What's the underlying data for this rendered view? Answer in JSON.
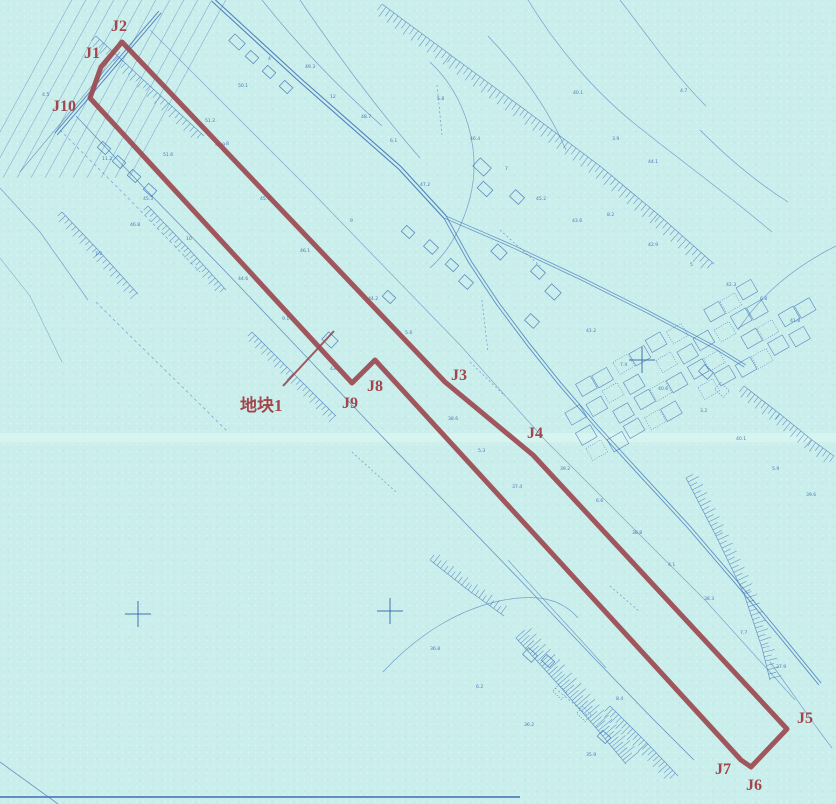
{
  "canvas": {
    "w": 836,
    "h": 804,
    "bg": "#c9eeec"
  },
  "colors": {
    "blue": "#3e6db4",
    "blue_dark": "#2c5ca4",
    "red": "#9b4950",
    "red_text": "#a2464c",
    "crease": "#daf5f1",
    "crease_edge": "#bfe2dc"
  },
  "boundary": {
    "stroke_width": 5,
    "vertices": [
      {
        "name": "J2",
        "x": 122,
        "y": 42,
        "label_x": 111,
        "label_y": 31
      },
      {
        "name": "J3",
        "x": 445,
        "y": 382,
        "label_x": 451,
        "label_y": 380
      },
      {
        "name": "J4",
        "x": 533,
        "y": 455,
        "label_x": 527,
        "label_y": 438
      },
      {
        "name": "J5",
        "x": 787,
        "y": 729,
        "label_x": 797,
        "label_y": 723
      },
      {
        "name": "J6",
        "x": 751,
        "y": 767,
        "label_x": 746,
        "label_y": 790
      },
      {
        "name": "J7",
        "x": 741,
        "y": 760,
        "label_x": 715,
        "label_y": 774
      },
      {
        "name": "J8",
        "x": 375,
        "y": 360,
        "label_x": 367,
        "label_y": 391
      },
      {
        "name": "J9",
        "x": 352,
        "y": 383,
        "label_x": 342,
        "label_y": 408
      },
      {
        "name": "J10",
        "x": 90,
        "y": 98,
        "label_x": 52,
        "label_y": 111
      },
      {
        "name": "J1",
        "x": 101,
        "y": 67,
        "label_x": 84,
        "label_y": 58
      }
    ],
    "plot_label": {
      "text": "地块1",
      "x": 240,
      "y": 411,
      "size": 17
    },
    "leader": [
      283,
      386,
      334,
      331
    ]
  },
  "map_features": {
    "crease": {
      "y": 433,
      "h": 11,
      "line_y": 443
    },
    "fan_lines": [
      [
        -25,
        178,
        75,
        -6
      ],
      [
        -11,
        178,
        89,
        -6
      ],
      [
        3,
        178,
        103,
        -6
      ],
      [
        17,
        178,
        117,
        -6
      ],
      [
        31,
        178,
        131,
        -6
      ],
      [
        45,
        178,
        145,
        -6
      ],
      [
        59,
        178,
        159,
        -6
      ],
      [
        73,
        178,
        173,
        -6
      ],
      [
        87,
        178,
        187,
        -6
      ],
      [
        101,
        178,
        201,
        -6
      ],
      [
        115,
        178,
        215,
        -6
      ],
      [
        129,
        178,
        229,
        -6
      ]
    ],
    "roads": [
      {
        "p": [
          [
            213,
            0
          ],
          [
            300,
            80
          ],
          [
            400,
            168
          ],
          [
            445,
            217
          ]
        ],
        "w": 1.1,
        "double": true,
        "gap": 3.4,
        "o": 0.85
      },
      {
        "p": [
          [
            445,
            217
          ],
          [
            512,
            246
          ],
          [
            580,
            278
          ],
          [
            648,
            312
          ],
          [
            716,
            348
          ],
          [
            745,
            366
          ]
        ],
        "w": 0.8,
        "double": true,
        "gap": 2.6,
        "o": 0.7
      },
      {
        "p": [
          [
            445,
            217
          ],
          [
            470,
            262
          ],
          [
            498,
            304
          ],
          [
            528,
            344
          ],
          [
            560,
            384
          ],
          [
            598,
            428
          ],
          [
            640,
            474
          ],
          [
            688,
            526
          ],
          [
            736,
            582
          ],
          [
            784,
            640
          ],
          [
            820,
            684
          ]
        ],
        "w": 0.9,
        "double": true,
        "gap": 3,
        "o": 0.75
      },
      {
        "p": [
          [
            76,
            116
          ],
          [
            150,
            194
          ],
          [
            224,
            270
          ],
          [
            298,
            348
          ],
          [
            372,
            426
          ],
          [
            446,
            503
          ],
          [
            520,
            580
          ],
          [
            594,
            658
          ],
          [
            652,
            718
          ],
          [
            694,
            760
          ]
        ],
        "w": 0.8,
        "o": 0.7
      },
      {
        "p": [
          [
            56,
            134
          ],
          [
            160,
            12
          ]
        ],
        "w": 1.0,
        "double": true,
        "gap": 3,
        "o": 0.8
      },
      {
        "p": [
          [
            20,
            172
          ],
          [
            120,
            52
          ]
        ],
        "w": 0.7,
        "o": 0.6
      },
      {
        "p": [
          [
            150,
            30
          ],
          [
            310,
            190
          ],
          [
            460,
            345
          ],
          [
            545,
            440
          ],
          [
            705,
            600
          ],
          [
            795,
            700
          ]
        ],
        "w": 0.7,
        "o": 0.55
      },
      {
        "p": [
          [
            60,
            130
          ],
          [
            130,
            200
          ],
          [
            200,
            272
          ]
        ],
        "w": 0.7,
        "dash": "3 3",
        "o": 0.6
      },
      {
        "p": [
          [
            0,
            188
          ],
          [
            40,
            232
          ],
          [
            88,
            300
          ]
        ],
        "w": 0.7,
        "o": 0.6
      },
      {
        "p": [
          [
            0,
            258
          ],
          [
            30,
            296
          ],
          [
            62,
            362
          ]
        ],
        "w": 0.6,
        "o": 0.5
      }
    ],
    "contours": [
      {
        "d": "M 262,0 C 300,48 344,92 382,126"
      },
      {
        "d": "M 300,0 C 338,56 380,112 420,158"
      },
      {
        "d": "M 528,0 C 556,46 594,92 640,128 C 688,166 732,198 772,232"
      },
      {
        "d": "M 620,0 C 648,36 672,72 706,106"
      },
      {
        "d": "M 430,62 C 466,96 482,150 470,198 C 462,228 448,252 430,268"
      },
      {
        "d": "M 488,36 C 520,70 548,108 566,150"
      },
      {
        "d": "M 836,246 C 792,268 760,296 738,330"
      },
      {
        "d": "M 383,672 C 420,632 462,608 504,600 C 544,593 564,602 578,618"
      },
      {
        "d": "M 770,662 C 792,692 812,722 832,748"
      },
      {
        "d": "M 700,130 C 728,158 756,182 788,202"
      },
      {
        "d": "M 96,302 C 140,346 186,390 228,432",
        "dash": "3 3"
      },
      {
        "d": "M 508,560 C 540,596 574,632 606,668"
      }
    ],
    "dashed_lines": [
      [
        437,
        85,
        442,
        135
      ],
      [
        482,
        300,
        488,
        352
      ],
      [
        500,
        230,
        540,
        266
      ],
      [
        352,
        452,
        396,
        492
      ],
      [
        555,
        688,
        588,
        716
      ],
      [
        610,
        586,
        640,
        612
      ],
      [
        470,
        362,
        505,
        396
      ]
    ],
    "ladders": [
      {
        "p": [
          [
            382,
            4
          ],
          [
            452,
            56
          ],
          [
            528,
            112
          ],
          [
            600,
            166
          ],
          [
            660,
            216
          ],
          [
            714,
            264
          ]
        ],
        "w": 12,
        "step": 5,
        "side": 1
      },
      {
        "p": [
          [
            96,
            36
          ],
          [
            150,
            86
          ],
          [
            204,
            136
          ]
        ],
        "w": 10,
        "step": 5,
        "side": 1
      },
      {
        "p": [
          [
            148,
            206
          ],
          [
            188,
            248
          ],
          [
            226,
            290
          ]
        ],
        "w": 9,
        "step": 4.5,
        "side": 1
      },
      {
        "p": [
          [
            252,
            332
          ],
          [
            294,
            374
          ],
          [
            336,
            416
          ]
        ],
        "w": 9,
        "step": 4.5,
        "side": 1
      },
      {
        "p": [
          [
            430,
            560
          ],
          [
            468,
            590
          ],
          [
            504,
            616
          ]
        ],
        "w": 10,
        "step": 4.5,
        "side": -1
      },
      {
        "p": [
          [
            516,
            638
          ],
          [
            556,
            682
          ],
          [
            596,
            728
          ],
          [
            626,
            764
          ]
        ],
        "w": 18,
        "step": 3.5,
        "side": -1
      },
      {
        "p": [
          [
            610,
            706
          ],
          [
            648,
            744
          ],
          [
            678,
            776
          ]
        ],
        "w": 12,
        "step": 4,
        "side": 1
      },
      {
        "p": [
          [
            686,
            478
          ],
          [
            716,
            536
          ],
          [
            744,
            594
          ],
          [
            762,
            648
          ],
          [
            770,
            680
          ]
        ],
        "w": 12,
        "step": 4.5,
        "side": -1
      },
      {
        "p": [
          [
            744,
            386
          ],
          [
            780,
            414
          ],
          [
            812,
            440
          ],
          [
            834,
            456
          ]
        ],
        "w": 11,
        "step": 4.5,
        "side": 1
      },
      {
        "p": [
          [
            62,
            212
          ],
          [
            100,
            252
          ],
          [
            138,
            294
          ]
        ],
        "w": 9,
        "step": 5,
        "side": 1
      }
    ],
    "buildings": [
      [
        104,
        148,
        11,
        8,
        43,
        0
      ],
      [
        119,
        162,
        11,
        8,
        43,
        0
      ],
      [
        134,
        176,
        11,
        8,
        43,
        0
      ],
      [
        150,
        190,
        11,
        8,
        43,
        0
      ],
      [
        237,
        42,
        14,
        9,
        43,
        0
      ],
      [
        252,
        57,
        11,
        8,
        43,
        0
      ],
      [
        269,
        72,
        11,
        8,
        43,
        0
      ],
      [
        286,
        87,
        11,
        8,
        43,
        0
      ],
      [
        482,
        167,
        15,
        11,
        43,
        0
      ],
      [
        485,
        189,
        13,
        9,
        43,
        0
      ],
      [
        517,
        197,
        12,
        9,
        43,
        0
      ],
      [
        408,
        232,
        11,
        8,
        43,
        0
      ],
      [
        431,
        247,
        12,
        9,
        43,
        0
      ],
      [
        452,
        265,
        11,
        8,
        43,
        0
      ],
      [
        466,
        282,
        12,
        9,
        43,
        0
      ],
      [
        499,
        252,
        13,
        10,
        43,
        0
      ],
      [
        538,
        272,
        12,
        9,
        43,
        0
      ],
      [
        553,
        292,
        13,
        10,
        43,
        0
      ],
      [
        532,
        321,
        12,
        9,
        43,
        0
      ],
      [
        389,
        297,
        11,
        8,
        43,
        0
      ],
      [
        330,
        340,
        13,
        10,
        43,
        0
      ],
      [
        530,
        655,
        12,
        9,
        43,
        0
      ],
      [
        548,
        661,
        11,
        8,
        43,
        0
      ],
      [
        560,
        692,
        12,
        9,
        43,
        1
      ],
      [
        584,
        714,
        12,
        9,
        43,
        1
      ],
      [
        604,
        737,
        11,
        8,
        43,
        0
      ],
      [
        706,
        372,
        12,
        9,
        43,
        0
      ],
      [
        722,
        390,
        12,
        9,
        43,
        1
      ]
    ],
    "parcel_grid": {
      "origin": [
        568,
        398
      ],
      "row_dir": [
        0.865,
        -0.5
      ],
      "col_dir": [
        0.5,
        0.865
      ],
      "pitch": 21,
      "cell": 17,
      "angle": -30,
      "cols_per_row": [
        11,
        12,
        13,
        13
      ],
      "skip_every": 7
    },
    "crosses": [
      [
        138,
        614
      ],
      [
        390,
        611
      ],
      [
        642,
        360
      ]
    ],
    "cross_arm": 13,
    "tiny_labels": [
      [
        42,
        96,
        "4.5"
      ],
      [
        205,
        122,
        "51.2"
      ],
      [
        226,
        145,
        "8"
      ],
      [
        130,
        226,
        "46.8"
      ],
      [
        95,
        255,
        "7.2"
      ],
      [
        163,
        156,
        "51.6"
      ],
      [
        238,
        87,
        "50.1"
      ],
      [
        268,
        60,
        "4"
      ],
      [
        305,
        68,
        "49.3"
      ],
      [
        330,
        98,
        "12"
      ],
      [
        361,
        118,
        "48.7"
      ],
      [
        390,
        142,
        "6.1"
      ],
      [
        420,
        186,
        "47.2"
      ],
      [
        350,
        222,
        "9"
      ],
      [
        300,
        252,
        "46.1"
      ],
      [
        260,
        200,
        "45.7"
      ],
      [
        215,
        146,
        "44.9"
      ],
      [
        437,
        100,
        "5.8"
      ],
      [
        470,
        140,
        "46.4"
      ],
      [
        505,
        170,
        "7"
      ],
      [
        536,
        200,
        "45.2"
      ],
      [
        573,
        94,
        "40.1"
      ],
      [
        612,
        140,
        "3.9"
      ],
      [
        648,
        163,
        "44.1"
      ],
      [
        680,
        92,
        "4.7"
      ],
      [
        572,
        222,
        "43.6"
      ],
      [
        607,
        216,
        "8.2"
      ],
      [
        648,
        246,
        "42.9"
      ],
      [
        690,
        266,
        "5"
      ],
      [
        726,
        286,
        "42.3"
      ],
      [
        760,
        300,
        "6.8"
      ],
      [
        790,
        322,
        "41.8"
      ],
      [
        586,
        332,
        "41.2"
      ],
      [
        620,
        366,
        "7.4"
      ],
      [
        658,
        390,
        "40.6"
      ],
      [
        700,
        412,
        "3.2"
      ],
      [
        736,
        440,
        "40.1"
      ],
      [
        772,
        470,
        "5.9"
      ],
      [
        806,
        496,
        "39.6"
      ],
      [
        560,
        470,
        "39.2"
      ],
      [
        596,
        502,
        "6.6"
      ],
      [
        632,
        534,
        "38.8"
      ],
      [
        668,
        566,
        "4.1"
      ],
      [
        704,
        600,
        "38.3"
      ],
      [
        740,
        634,
        "7.7"
      ],
      [
        776,
        668,
        "37.9"
      ],
      [
        448,
        420,
        "38.6"
      ],
      [
        478,
        452,
        "5.3"
      ],
      [
        512,
        488,
        "37.4"
      ],
      [
        430,
        650,
        "36.8"
      ],
      [
        476,
        688,
        "6.2"
      ],
      [
        524,
        726,
        "36.2"
      ],
      [
        586,
        756,
        "35.9"
      ],
      [
        616,
        700,
        "8.4"
      ],
      [
        368,
        300,
        "44.2"
      ],
      [
        405,
        334,
        "5.6"
      ],
      [
        330,
        370,
        "43.1"
      ],
      [
        282,
        320,
        "9.1"
      ],
      [
        238,
        280,
        "44.6"
      ],
      [
        186,
        240,
        "10"
      ],
      [
        143,
        200,
        "45.3"
      ],
      [
        102,
        160,
        "11.2"
      ]
    ],
    "bottom_line": {
      "y": 797,
      "x1": 0,
      "x2": 520
    },
    "corner_line": [
      0,
      762,
      58,
      804
    ]
  }
}
